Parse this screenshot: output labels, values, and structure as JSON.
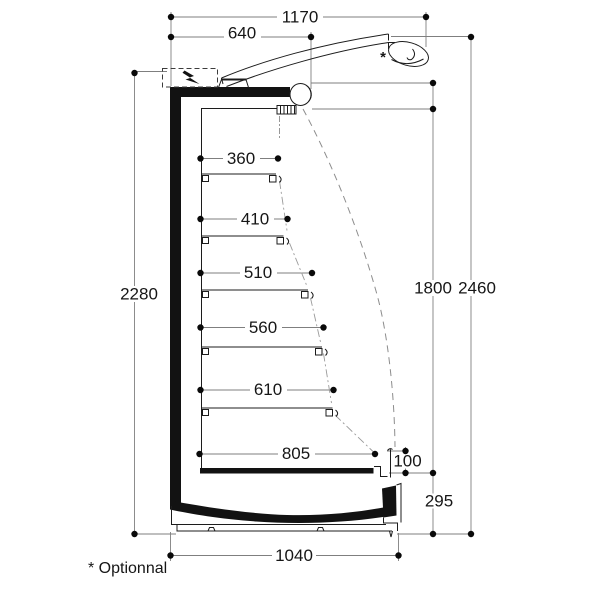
{
  "drawing": {
    "kind": "refrigerated-display-cabinet-side-section",
    "units": "mm"
  },
  "dimensions": {
    "overall_depth": "1170",
    "canopy_depth": "640",
    "back_height": "2280",
    "opening_height": "1800",
    "overall_height": "2460",
    "sill_height": "100",
    "base_height": "295",
    "base_depth": "1040"
  },
  "shelf_depths": [
    "360",
    "410",
    "510",
    "560",
    "610",
    "805"
  ],
  "note": {
    "marker": "*",
    "full": "* Optionnal"
  },
  "colors": {
    "object_line": "#1c1c1c",
    "dimension_line": "#7f7f7f",
    "background": "#ffffff",
    "solid_fill": "#121212"
  }
}
